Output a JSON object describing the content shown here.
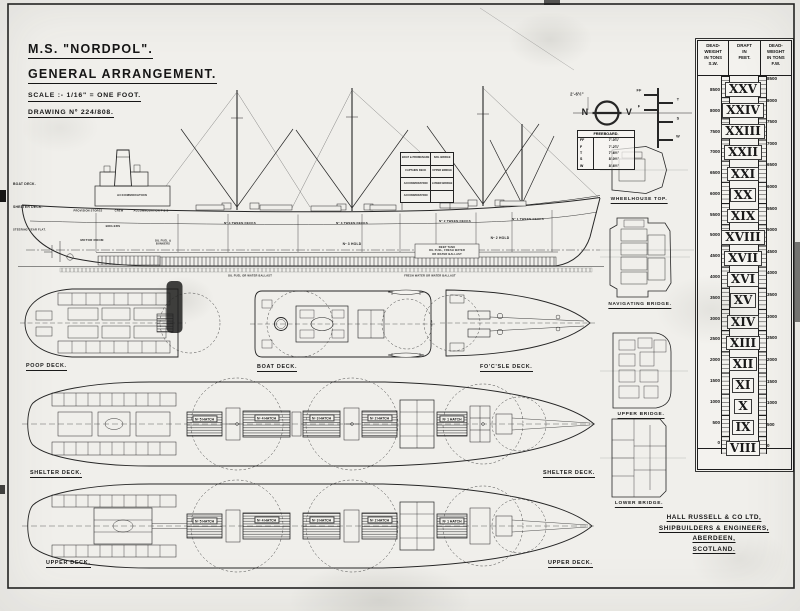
{
  "title_block": {
    "name": "M.S. \"NORDPOL\".",
    "subtitle": "GENERAL ARRANGEMENT.",
    "scale": "SCALE :- 1/16\" = ONE FOOT.",
    "drawing_no": "DRAWING Nº 224/808."
  },
  "builder_block": {
    "line1": "HALL RUSSELL & CO LTD,",
    "line2": "SHIPBUILDERS & ENGINEERS,",
    "line3": "ABERDEEN,",
    "line4": "SCOTLAND."
  },
  "freeboard_table": {
    "title": "FREEBOARD.",
    "rows": [
      {
        "mark": "FF",
        "value": "7'-0¾\""
      },
      {
        "mark": "F",
        "value": "7'-2¾\""
      },
      {
        "mark": "T",
        "value": "7'-6½\""
      },
      {
        "mark": "S",
        "value": "8'-0½\""
      },
      {
        "mark": "W",
        "value": "8'-6½\""
      }
    ],
    "dimension": "2'-6½\""
  },
  "load_line": {
    "left_letter": "N",
    "right_letter": "V",
    "mark_ff": "FF",
    "mark_f": "F",
    "mark_t": "T",
    "mark_s": "S",
    "mark_w": "W"
  },
  "profile_labels": {
    "boat_deck": "BOAT DECK.",
    "shelter_deck": "SHELTER DECK.",
    "steering_flat": "STEERING GEAR FLAT.",
    "accommodation": "ACCOMMODATION",
    "provision": "PROVISION STORES",
    "crew": "CREW",
    "accommodation_ps": "ACCOMMODATION P & S",
    "boilers": "BOILERS",
    "motor_room": "MOTOR ROOM",
    "oil_fuel_bunkers": "OIL FUEL &\nBUNKERS",
    "tween4": "Nº 4 TWEEN DECKS",
    "tween3": "Nº 3 TWEEN DECKS",
    "tween2": "Nº 2 TWEEN DECKS",
    "tween1": "Nº 1 TWEEN DECKS",
    "hold3": "Nº 3 HOLD",
    "hold2": "Nº 2 HOLD",
    "deep_tank": "DEEP TANK\nOIL FUEL, FRESH WATER\nOR WATER BALLAST",
    "db_left": "OIL FUEL OR WATER BALLAST",
    "db_right": "FRESH WATER OR WATER BALLAST",
    "house_rows": [
      {
        "left": "BOAT & PROMENADE",
        "right": "NAV. BRIDGE"
      },
      {
        "left": "CAPTAINS DECK",
        "right": "UPPER BRIDGE"
      },
      {
        "left": "ACCOMMODATION",
        "right": "LOWER BRIDGE"
      },
      {
        "left": "ACCOMMODATION",
        "right": ""
      }
    ]
  },
  "deck_plan_labels": {
    "poop": "POOP DECK.",
    "boat": "BOAT DECK.",
    "focsle": "FO'C'SLE DECK.",
    "shelter_left": "SHELTER DECK.",
    "shelter_right": "SHELTER DECK.",
    "upper_left": "UPPER DECK.",
    "upper_right": "UPPER DECK."
  },
  "side_plan_labels": {
    "wheelhouse": "WHEELHOUSE TOP.",
    "nav": "NAVIGATING BRIDGE.",
    "upper": "UPPER BRIDGE.",
    "lower": "LOWER BRIDGE."
  },
  "hatches_shelter": [
    "Nº 5 HATCH",
    "Nº 4 HATCH",
    "Nº 3 HATCH",
    "Nº 2 HATCH",
    "Nº 1 HATCH"
  ],
  "hatches_upper": [
    "Nº 5 HATCH",
    "Nº 4 HATCH",
    "Nº 3 HATCH",
    "Nº 2 HATCH",
    "Nº 1 HATCH"
  ],
  "deadweight_scale": {
    "header_sw": "DEAD-\nWEIGHT\nIN TONS\nS.W.",
    "header_draft": "DRAFT\nIN\nFEET.",
    "header_fw": "DEAD-\nWEIGHT\nIN TONS\nF.W.",
    "sw_values": [
      "8500",
      "8000",
      "7500",
      "7000",
      "6500",
      "6000",
      "5500",
      "5000",
      "4500",
      "4000",
      "3500",
      "3000",
      "2500",
      "2000",
      "1500",
      "1000",
      "500",
      "0"
    ],
    "draft_feet_roman": [
      "XXV",
      "XXIV",
      "XXIII",
      "XXII",
      "XXI",
      "XX",
      "XIX",
      "XVIII",
      "XVII",
      "XVI",
      "XV",
      "XIV",
      "XIII",
      "XII",
      "XI",
      "X",
      "IX",
      "VIII"
    ],
    "fw_values": [
      "8500",
      "8000",
      "7500",
      "7000",
      "6500",
      "6000",
      "5500",
      "5000",
      "4500",
      "4000",
      "3500",
      "3000",
      "2500",
      "2000",
      "1500",
      "1000",
      "500",
      "0"
    ]
  }
}
